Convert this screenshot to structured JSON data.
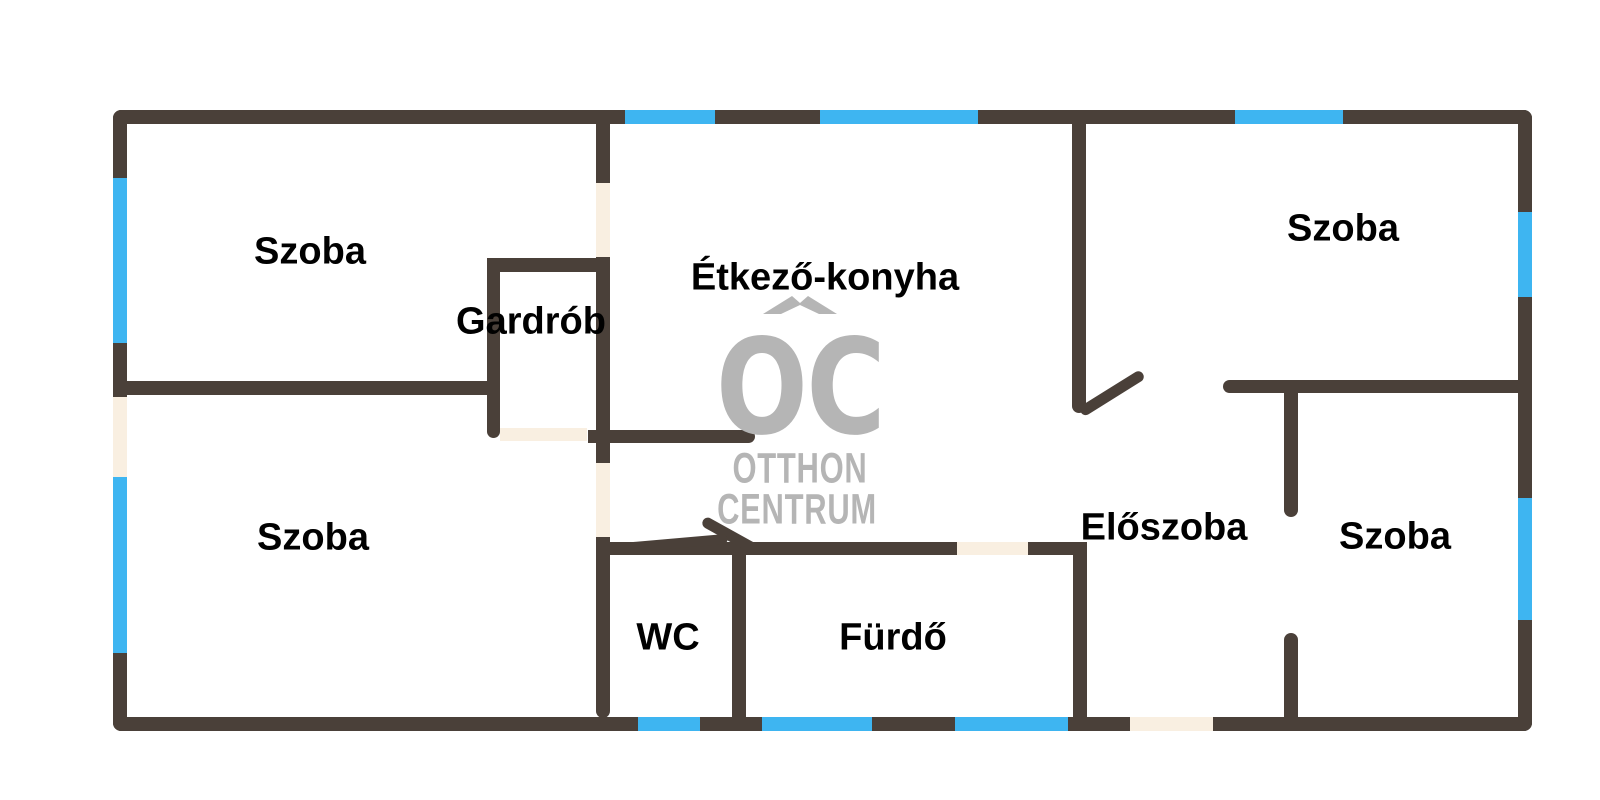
{
  "title": "Lakás alaprajz (apartment floor plan)",
  "colors": {
    "wall": "#4a4039",
    "window": "#3eb5f1",
    "door": "#f9efe1",
    "logo": "#b5b5b5",
    "text": "#000000",
    "background": "#ffffff"
  },
  "rooms": [
    {
      "id": "szoba-top-left",
      "label": "Szoba",
      "x": 310,
      "y": 252
    },
    {
      "id": "gardrob",
      "label": "Gardrób",
      "x": 531,
      "y": 322
    },
    {
      "id": "etkezo-konyha",
      "label": "Étkező-konyha",
      "x": 825,
      "y": 278
    },
    {
      "id": "szoba-top-right",
      "label": "Szoba",
      "x": 1343,
      "y": 229
    },
    {
      "id": "szoba-bottom-left",
      "label": "Szoba",
      "x": 313,
      "y": 538
    },
    {
      "id": "wc",
      "label": "WC",
      "x": 668,
      "y": 638
    },
    {
      "id": "furdo",
      "label": "Fürdő",
      "x": 893,
      "y": 638
    },
    {
      "id": "eloszoba",
      "label": "Előszoba",
      "x": 1164,
      "y": 528
    },
    {
      "id": "szoba-bottom-right",
      "label": "Szoba",
      "x": 1395,
      "y": 537
    }
  ],
  "watermark": {
    "monogram": "OC",
    "line1": "OTTHON",
    "line2": "CENTRUM"
  }
}
